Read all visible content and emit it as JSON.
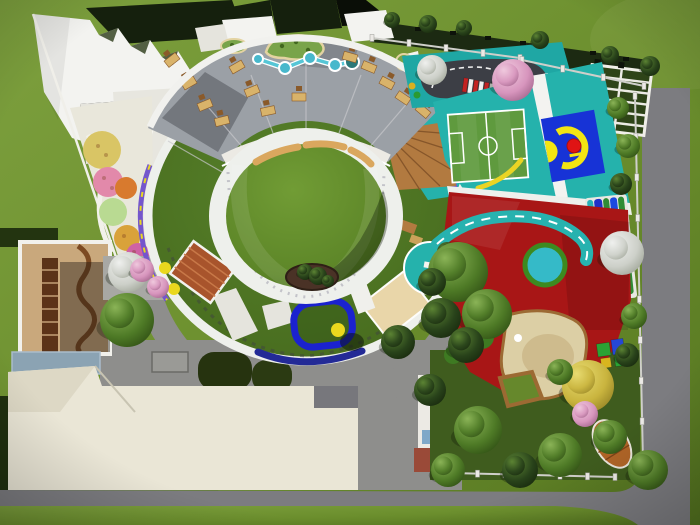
{
  "image_description": "aerial 3d rendering of a kindergarten campus with circular building, sports courts and playgrounds",
  "colors": {
    "grass": "#6e9030",
    "road": "#7c7c80",
    "hedge": "#1c2a12",
    "roof_dark": "#15200d",
    "roof_black": "#0a0e07",
    "white_roof": "#f3f3f0",
    "white_dim": "#e5e4dd",
    "plaza": "#e7e6df",
    "interior_floor": "#9ba0a6",
    "ring_white": "#eef0ec",
    "courtyard": "#66912e",
    "roof_ring": "#4e7523",
    "teal": "#25b2ac",
    "teal_deep": "#1fa7a4",
    "field_green": "#5f9a3e",
    "court_blue": "#1733d6",
    "court_yellow": "#f2e513",
    "court_red": "#e01414",
    "red_ground": "#a81616",
    "cyan_pool": "#35bac8",
    "pool_ring": "#3d8a20",
    "road_teal": "#27b2af",
    "sand": "#dccfa5",
    "sand_rim": "#9c6a33",
    "wood": "#b27a40",
    "wood_dark": "#86562a",
    "purple": "#7456cc",
    "canopy_tan": "#e9d6a9",
    "track_blue": "#1b22cf",
    "beige": "#eae6d6",
    "beige_dim": "#ddd8c5",
    "concrete": "#8e8e8c",
    "slate": "#8ba3b3",
    "floor_tan": "#c9a87c",
    "shelf": "#5b3318",
    "wall_brown": "#7c4a22",
    "lane_blue": "#2030c8",
    "lane_blue2": "#1b49e0",
    "lane_green": "#2f8c35",
    "lane_teal": "#28b0b8",
    "stream": "#56c6d6",
    "bench": "#daa75e",
    "asphalt": "#3c3e45",
    "barrier_red": "#c32222",
    "fence_white": "#eceae6",
    "rail": "#cfcfca",
    "desk_tan": "#d9b36a",
    "desk_brown": "#8a5a2a",
    "flower_pink": "#e289aa",
    "flower_orange": "#d87a2e",
    "flower_yellow": "#d9c565",
    "flower_lgreen": "#b9da92",
    "flower_magenta": "#cf62a4",
    "bed_red": "#8f1010",
    "slide_yellow": "#ead81e",
    "hedge_blob": "#26330f",
    "dark_strip": "#20300f",
    "blue_arc": "#232a96",
    "box": "#9a9a96",
    "brick": "#9a4a38",
    "window": "#7fa8c8",
    "boat": "#b06527",
    "white_face": "#eceae4"
  },
  "scene": {
    "trees": [
      {
        "x": 392,
        "y": 20,
        "r": 8,
        "t": "d"
      },
      {
        "x": 428,
        "y": 24,
        "r": 9,
        "t": "d"
      },
      {
        "x": 464,
        "y": 28,
        "r": 8,
        "t": "d"
      },
      {
        "x": 540,
        "y": 40,
        "r": 9,
        "t": "d"
      },
      {
        "x": 610,
        "y": 55,
        "r": 9,
        "t": "d"
      },
      {
        "x": 650,
        "y": 66,
        "r": 10,
        "t": "d"
      },
      {
        "x": 618,
        "y": 108,
        "r": 11,
        "t": "g"
      },
      {
        "x": 628,
        "y": 146,
        "r": 12,
        "t": "g"
      },
      {
        "x": 621,
        "y": 184,
        "r": 11,
        "t": "d"
      },
      {
        "x": 634,
        "y": 316,
        "r": 13,
        "t": "g"
      },
      {
        "x": 627,
        "y": 355,
        "r": 12,
        "t": "d"
      },
      {
        "x": 432,
        "y": 70,
        "r": 15,
        "t": "w"
      },
      {
        "x": 513,
        "y": 80,
        "r": 21,
        "t": "p"
      },
      {
        "x": 622,
        "y": 253,
        "r": 22,
        "t": "w"
      },
      {
        "x": 447,
        "y": 252,
        "r": 10,
        "t": "d"
      },
      {
        "x": 458,
        "y": 272,
        "r": 30,
        "t": "g"
      },
      {
        "x": 487,
        "y": 314,
        "r": 25,
        "t": "g"
      },
      {
        "x": 441,
        "y": 318,
        "r": 20,
        "t": "d"
      },
      {
        "x": 466,
        "y": 345,
        "r": 18,
        "t": "d"
      },
      {
        "x": 432,
        "y": 282,
        "r": 14,
        "t": "d"
      },
      {
        "x": 398,
        "y": 342,
        "r": 17,
        "t": "d"
      },
      {
        "x": 430,
        "y": 390,
        "r": 16,
        "t": "d"
      },
      {
        "x": 588,
        "y": 386,
        "r": 26,
        "t": "y"
      },
      {
        "x": 560,
        "y": 372,
        "r": 13,
        "t": "g"
      },
      {
        "x": 585,
        "y": 414,
        "r": 13,
        "t": "p"
      },
      {
        "x": 610,
        "y": 437,
        "r": 17,
        "t": "g"
      },
      {
        "x": 648,
        "y": 470,
        "r": 20,
        "t": "g"
      },
      {
        "x": 560,
        "y": 455,
        "r": 22,
        "t": "g"
      },
      {
        "x": 520,
        "y": 470,
        "r": 18,
        "t": "d"
      },
      {
        "x": 478,
        "y": 430,
        "r": 24,
        "t": "g"
      },
      {
        "x": 448,
        "y": 470,
        "r": 17,
        "t": "g"
      },
      {
        "x": 128,
        "y": 272,
        "r": 20,
        "t": "w"
      },
      {
        "x": 127,
        "y": 320,
        "r": 27,
        "t": "g"
      },
      {
        "x": 142,
        "y": 270,
        "r": 12,
        "t": "p"
      },
      {
        "x": 158,
        "y": 287,
        "r": 11,
        "t": "p"
      },
      {
        "x": 305,
        "y": 272,
        "r": 8,
        "t": "d"
      },
      {
        "x": 318,
        "y": 276,
        "r": 9,
        "t": "d"
      },
      {
        "x": 328,
        "y": 281,
        "r": 6,
        "t": "d"
      }
    ],
    "desks": [
      {
        "x": 172,
        "y": 60,
        "a": -38
      },
      {
        "x": 189,
        "y": 83,
        "a": -30
      },
      {
        "x": 205,
        "y": 105,
        "a": -22
      },
      {
        "x": 222,
        "y": 121,
        "a": -14
      },
      {
        "x": 237,
        "y": 67,
        "a": -30
      },
      {
        "x": 252,
        "y": 91,
        "a": -22
      },
      {
        "x": 268,
        "y": 111,
        "a": -12
      },
      {
        "x": 299,
        "y": 97,
        "a": 0
      },
      {
        "x": 350,
        "y": 57,
        "a": 16
      },
      {
        "x": 369,
        "y": 67,
        "a": 22
      },
      {
        "x": 387,
        "y": 83,
        "a": 28
      },
      {
        "x": 403,
        "y": 98,
        "a": 34
      },
      {
        "x": 423,
        "y": 111,
        "a": 40
      },
      {
        "x": 428,
        "y": 88,
        "a": 34
      }
    ],
    "fences": [
      {
        "x1": 450,
        "y1": 473,
        "x2": 615,
        "y2": 477,
        "n": 7
      },
      {
        "x1": 635,
        "y1": 96,
        "x2": 643,
        "y2": 462,
        "n": 10
      },
      {
        "x1": 372,
        "y1": 38,
        "x2": 520,
        "y2": 58,
        "n": 5
      },
      {
        "x1": 522,
        "y1": 60,
        "x2": 644,
        "y2": 86,
        "n": 4
      }
    ],
    "stream_nodes": [
      {
        "x": 258,
        "y": 59,
        "r": 5
      },
      {
        "x": 285,
        "y": 68,
        "r": 6
      },
      {
        "x": 310,
        "y": 58,
        "r": 6
      },
      {
        "x": 335,
        "y": 65,
        "r": 6
      }
    ],
    "barrier_bars": 7
  }
}
